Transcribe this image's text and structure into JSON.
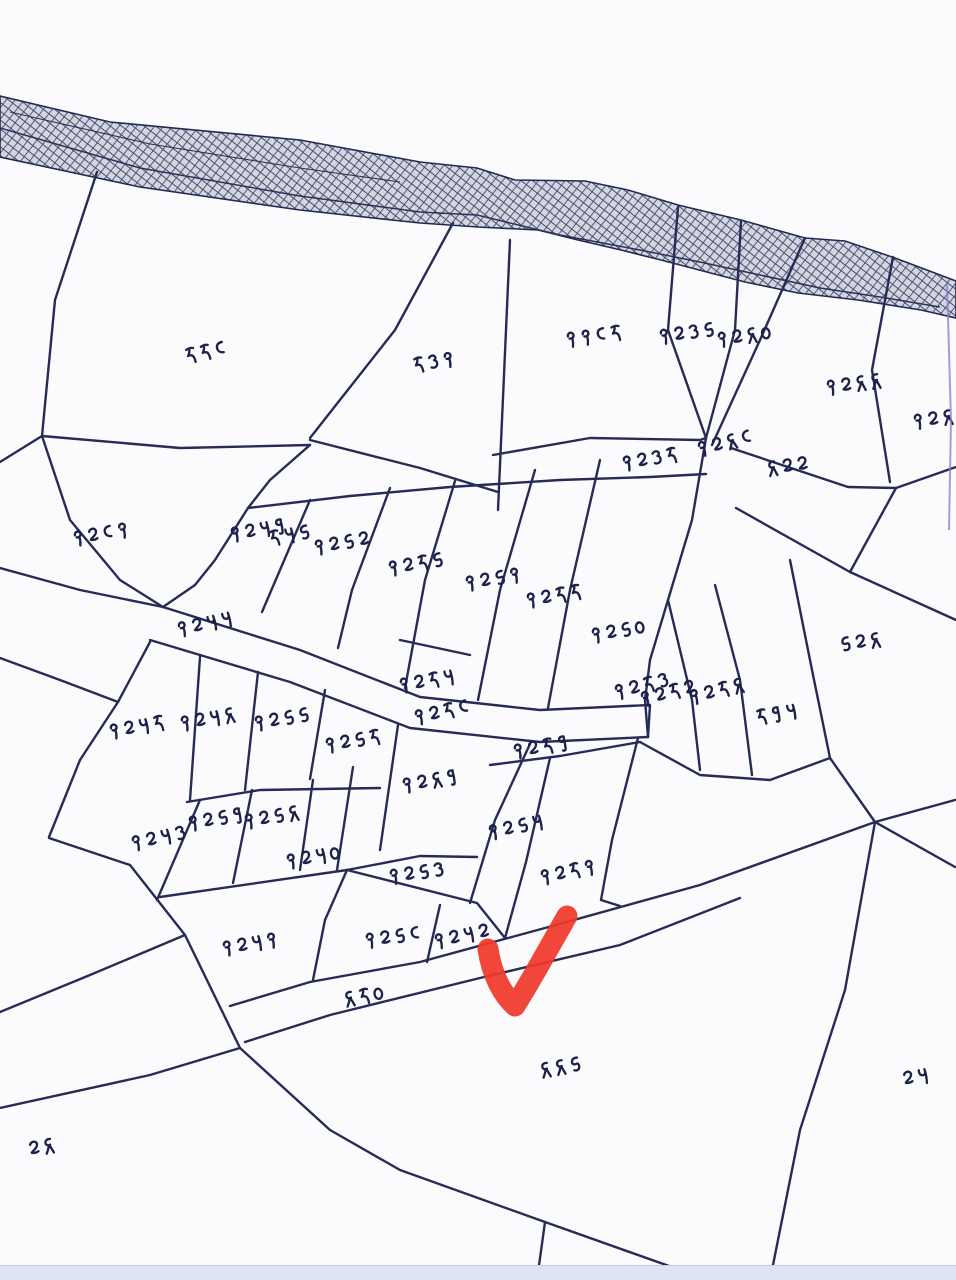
{
  "map": {
    "type": "cadastral-sketch",
    "parcels": [
      {
        "number": "५५८",
        "x": 205,
        "y": 352,
        "rot": -12
      },
      {
        "number": "५३१",
        "x": 433,
        "y": 362,
        "rot": -10
      },
      {
        "number": "११८५",
        "x": 593,
        "y": 336,
        "rot": -8
      },
      {
        "number": "१२३६",
        "x": 686,
        "y": 333,
        "rot": -8
      },
      {
        "number": "१२४०",
        "x": 744,
        "y": 336,
        "rot": -8
      },
      {
        "number": "१२४४",
        "x": 853,
        "y": 384,
        "rot": -8
      },
      {
        "number": "१२४५",
        "x": 940,
        "y": 418,
        "rot": -8
      },
      {
        "number": "१२३५",
        "x": 649,
        "y": 459,
        "rot": -10
      },
      {
        "number": "१२४८",
        "x": 724,
        "y": 443,
        "rot": -14
      },
      {
        "number": "४२२",
        "x": 787,
        "y": 466,
        "rot": -8
      },
      {
        "number": "१२८१",
        "x": 100,
        "y": 534,
        "rot": -10
      },
      {
        "number": "१२७९",
        "x": 257,
        "y": 530,
        "rot": -10
      },
      {
        "number": "५७६",
        "x": 289,
        "y": 535,
        "rot": -10
      },
      {
        "number": "१२६२",
        "x": 341,
        "y": 543,
        "rot": -10
      },
      {
        "number": "१२५६",
        "x": 415,
        "y": 564,
        "rot": -10
      },
      {
        "number": "१२६१",
        "x": 492,
        "y": 579,
        "rot": -10
      },
      {
        "number": "१२५५",
        "x": 553,
        "y": 596,
        "rot": -10
      },
      {
        "number": "१२६०",
        "x": 618,
        "y": 631,
        "rot": -10
      },
      {
        "number": "६२४",
        "x": 860,
        "y": 642,
        "rot": -8
      },
      {
        "number": "१२७७",
        "x": 204,
        "y": 624,
        "rot": -12
      },
      {
        "number": "१२५७",
        "x": 426,
        "y": 681,
        "rot": -10
      },
      {
        "number": "१२५८",
        "x": 441,
        "y": 712,
        "rot": -12
      },
      {
        "number": "१२५९",
        "x": 540,
        "y": 747,
        "rot": -10
      },
      {
        "number": "१२५३",
        "x": 641,
        "y": 686,
        "rot": -14
      },
      {
        "number": "१२५२",
        "x": 667,
        "y": 693,
        "rot": -14
      },
      {
        "number": "१२५४",
        "x": 716,
        "y": 691,
        "rot": -14
      },
      {
        "number": "५९७",
        "x": 776,
        "y": 714,
        "rot": -10
      },
      {
        "number": "१२७५",
        "x": 136,
        "y": 727,
        "rot": -10
      },
      {
        "number": "१२७४",
        "x": 207,
        "y": 719,
        "rot": -10
      },
      {
        "number": "१२६६",
        "x": 281,
        "y": 719,
        "rot": -10
      },
      {
        "number": "१२६५",
        "x": 352,
        "y": 741,
        "rot": -10
      },
      {
        "number": "१२४९",
        "x": 429,
        "y": 781,
        "rot": -10
      },
      {
        "number": "१२७३",
        "x": 158,
        "y": 838,
        "rot": -12
      },
      {
        "number": "१२६९",
        "x": 215,
        "y": 819,
        "rot": -10
      },
      {
        "number": "१२६४",
        "x": 271,
        "y": 817,
        "rot": -10
      },
      {
        "number": "१२७०",
        "x": 313,
        "y": 857,
        "rot": -10
      },
      {
        "number": "१२६३",
        "x": 416,
        "y": 873,
        "rot": -8
      },
      {
        "number": "१२६७",
        "x": 515,
        "y": 827,
        "rot": -12
      },
      {
        "number": "१२५१",
        "x": 567,
        "y": 872,
        "rot": -12
      },
      {
        "number": "१२७१",
        "x": 249,
        "y": 944,
        "rot": -10
      },
      {
        "number": "१२६८",
        "x": 392,
        "y": 937,
        "rot": -8
      },
      {
        "number": "१२७२",
        "x": 461,
        "y": 936,
        "rot": -12
      },
      {
        "number": "४५०",
        "x": 364,
        "y": 996,
        "rot": -10
      },
      {
        "number": "४४६",
        "x": 560,
        "y": 1067,
        "rot": -10
      },
      {
        "number": "२७",
        "x": 915,
        "y": 1077,
        "rot": -10
      },
      {
        "number": "२४",
        "x": 41,
        "y": 1147,
        "rot": -10
      }
    ],
    "annotation": {
      "type": "red-checkmark",
      "color": "#ef392b"
    },
    "colors": {
      "ink": "#232a52",
      "label_ink": "#1c2248",
      "paper": "#fbfbfd",
      "hatch_fill": "#d3d6e0",
      "hatch_line": "#474d6b",
      "scan_edge_strip": "#dde5f3",
      "scan_artifact": "#8a7ad0"
    }
  }
}
